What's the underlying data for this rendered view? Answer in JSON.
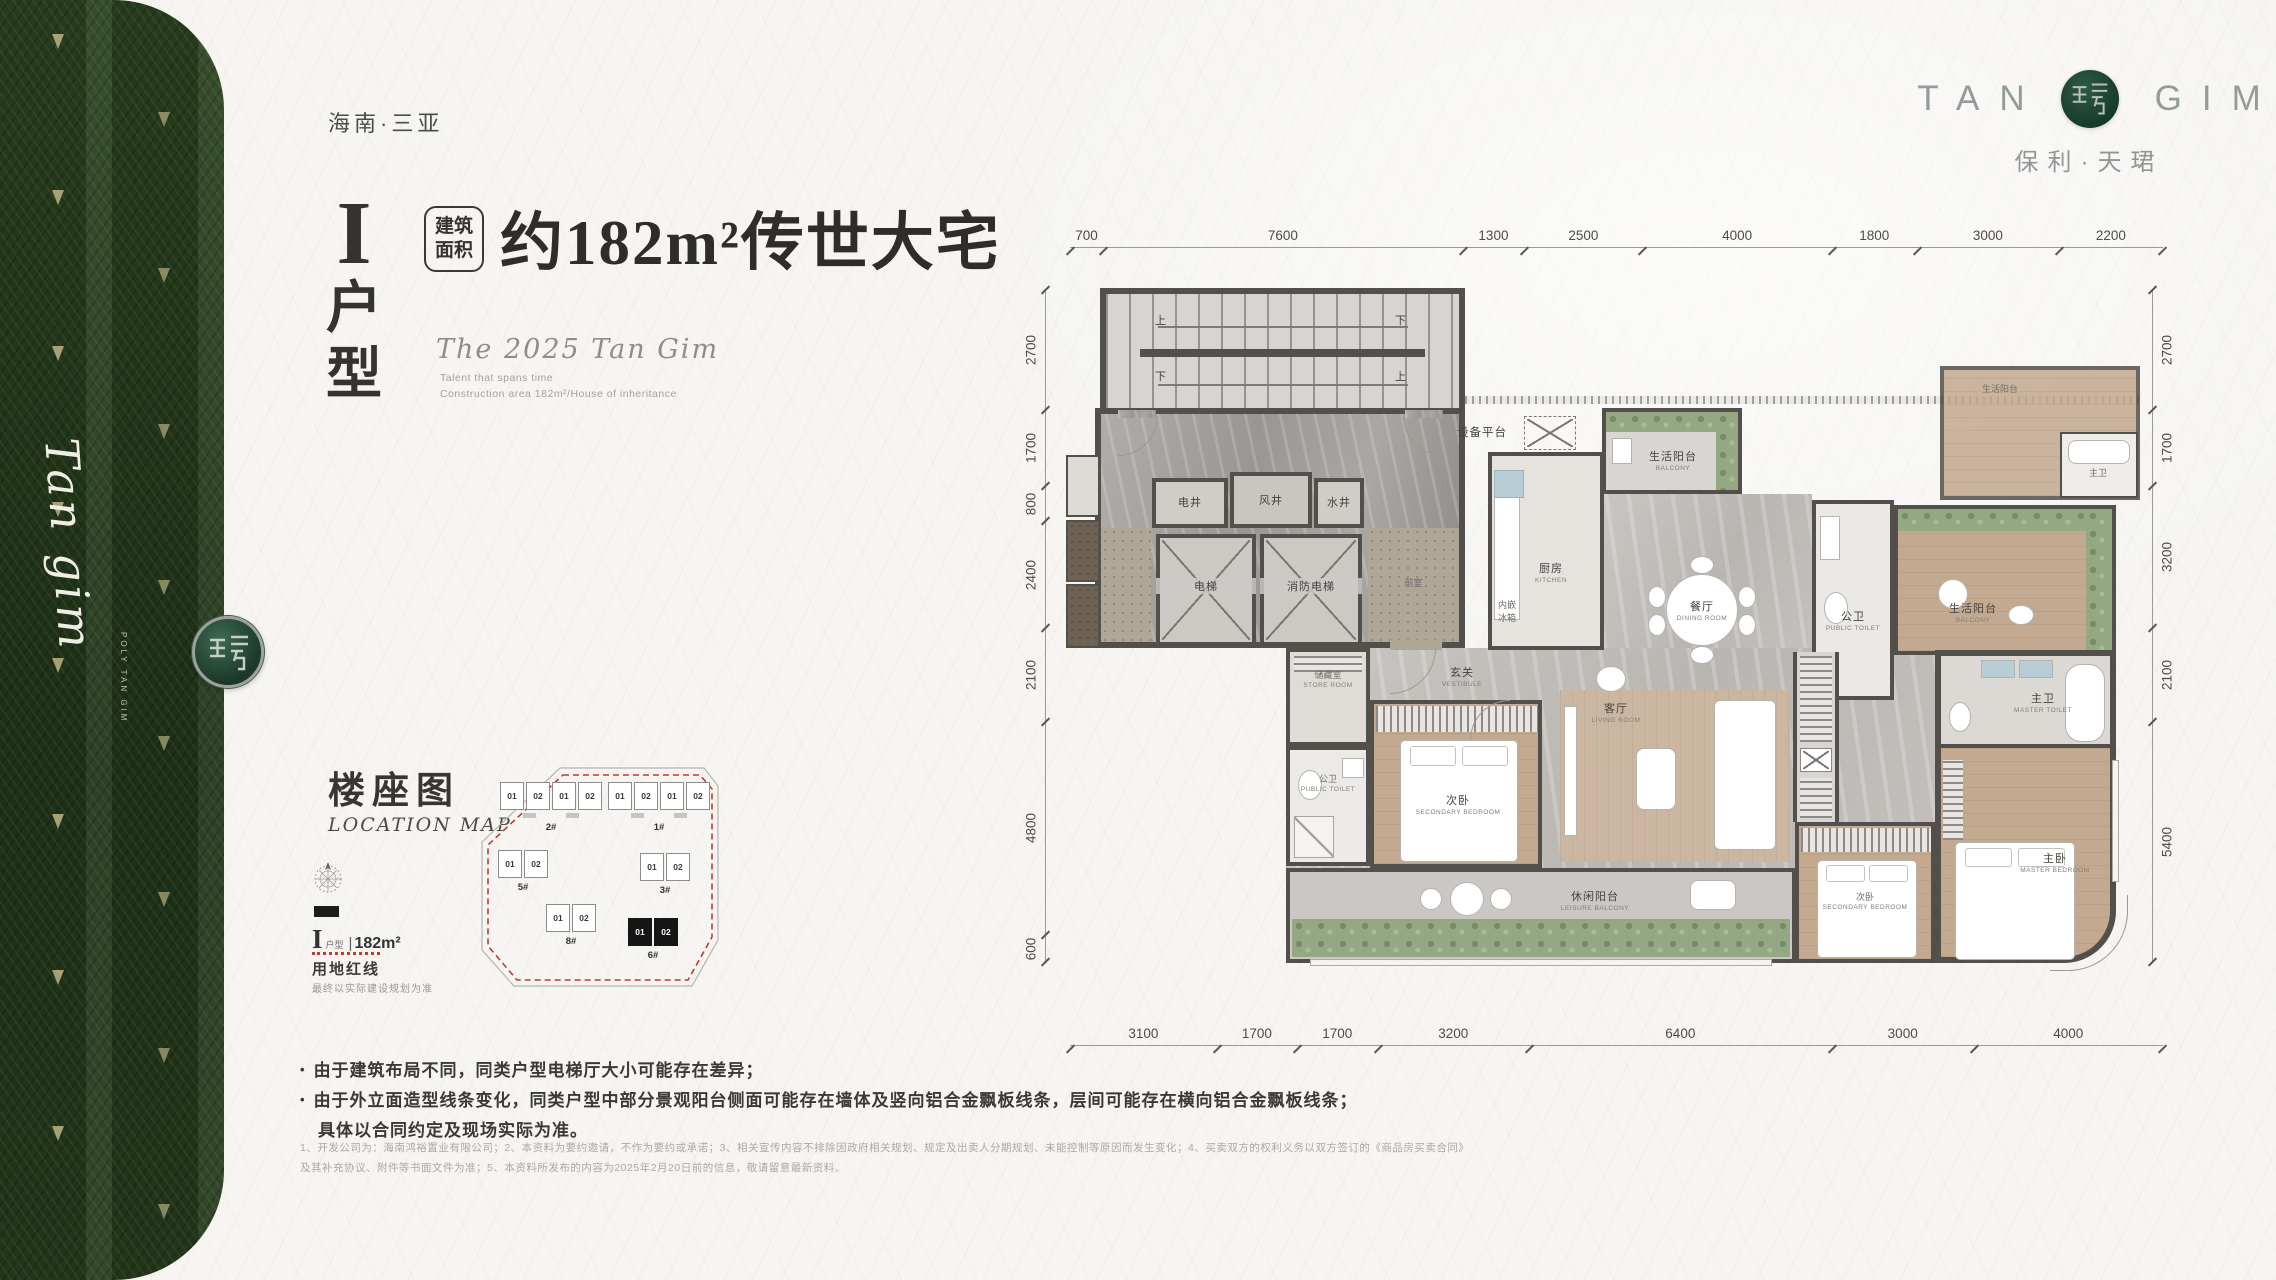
{
  "page": {
    "location_tag": "海南·三亚"
  },
  "brand": {
    "logo_tan": "TAN",
    "logo_gim": "GIM",
    "logo_cn": "保利·天珺",
    "strip_script": "Tan gim",
    "strip_caption": "POLY TAN GIM",
    "green": "#2c4520",
    "gold": "#cec391",
    "redline": "#bf3a32"
  },
  "header": {
    "unit_roman": "I",
    "unit_chars": [
      "户",
      "型"
    ],
    "area_tag": [
      "建筑",
      "面积"
    ],
    "headline": "约182m²传世大宅",
    "subtitle": "The 2025 Tan Gim",
    "sub_lines": [
      "Talent that spans time",
      "Construction area 182m²/House of inheritance"
    ]
  },
  "location_map": {
    "title": "楼座图",
    "title_en": "LOCATION MAP",
    "legend_unit": "I",
    "legend_unit_type": "户型",
    "legend_divider": "|",
    "legend_area": "182m²",
    "redline_label": "用地红线",
    "redline_note": "最终以实际建设规划为准",
    "buildings": [
      {
        "id": "2#",
        "units": [
          "01",
          "02",
          "01",
          "02"
        ],
        "x": 32,
        "y": 28,
        "dark": false
      },
      {
        "id": "1#",
        "units": [
          "01",
          "02",
          "01",
          "02"
        ],
        "x": 140,
        "y": 28,
        "dark": false
      },
      {
        "id": "5#",
        "units": [
          "01",
          "02"
        ],
        "x": 30,
        "y": 96,
        "dark": false
      },
      {
        "id": "3#",
        "units": [
          "01",
          "02"
        ],
        "x": 172,
        "y": 99,
        "dark": false
      },
      {
        "id": "8#",
        "units": [
          "01",
          "02"
        ],
        "x": 78,
        "y": 150,
        "dark": false
      },
      {
        "id": "6#",
        "units": [
          "01",
          "02"
        ],
        "x": 160,
        "y": 164,
        "dark": true
      }
    ]
  },
  "floorplan": {
    "dims_top": [
      "700",
      "7600",
      "1300",
      "2500",
      "4000",
      "1800",
      "3000",
      "2200"
    ],
    "dims_left": [
      "2700",
      "1700",
      "800",
      "2400",
      "2100",
      "4800",
      "600"
    ],
    "dims_right": [
      "2700",
      "1700",
      "3200",
      "2100",
      "5400"
    ],
    "dims_bottom": [
      "3100",
      "1700",
      "1700",
      "3200",
      "6400",
      "3000",
      "4000"
    ],
    "rooms": {
      "stairs_up": "上",
      "stairs_down": "下",
      "shaft_elec": "电井",
      "shaft_air": "风井",
      "shaft_water": "水井",
      "elevator": "电梯",
      "fire_elevator": "消防电梯",
      "front_hall": "前室",
      "equipment": "设备平台",
      "balcony_life": {
        "cn": "生活阳台",
        "en": "BALCONY"
      },
      "kitchen": {
        "cn": "厨房",
        "en": "KITCHEN"
      },
      "fridge": [
        "内嵌",
        "冰箱"
      ],
      "dining": {
        "cn": "餐厅",
        "en": "DINING ROOM"
      },
      "toilet_public": {
        "cn": "公卫",
        "en": "PUBLIC TOILET"
      },
      "master_toilet": {
        "cn": "主卫",
        "en": "MASTER TOILET"
      },
      "vestibule": {
        "cn": "玄关",
        "en": "VESTIBULE"
      },
      "store": {
        "cn": "储藏室",
        "en": "STORE ROOM"
      },
      "bedroom_secondary": {
        "cn": "次卧",
        "en": "SECONDARY BEDROOM"
      },
      "living": {
        "cn": "客厅",
        "en": "LIVING ROOM"
      },
      "master_bedroom": {
        "cn": "主卧",
        "en": "MASTER BEDROOM"
      },
      "leisure_balcony": {
        "cn": "休闲阳台",
        "en": "LEISURE BALCONY"
      }
    }
  },
  "notes": {
    "bullets": [
      "由于建筑布局不同，同类户型电梯厅大小可能存在差异；",
      "由于外立面造型线条变化，同类户型中部分景观阳台侧面可能存在墙体及竖向铝合金飘板线条，层间可能存在横向铝合金飘板线条；",
      "具体以合同约定及现场实际为准。"
    ],
    "fine_print": [
      "1、开发公司为：海南鸿裕置业有限公司；2、本资料为要约邀请，不作为要约或承诺；3、相关宣传内容不排除因政府相关规划、规定及出卖人分期规划、未能控制等原因而发生变化；4、买卖双方的权利义务以双方签订的《商品房买卖合同》",
      "及其补充协议、附件等书面文件为准；5、本资料所发布的内容为2025年2月20日前的信息，敬请留意最新资料。"
    ]
  }
}
